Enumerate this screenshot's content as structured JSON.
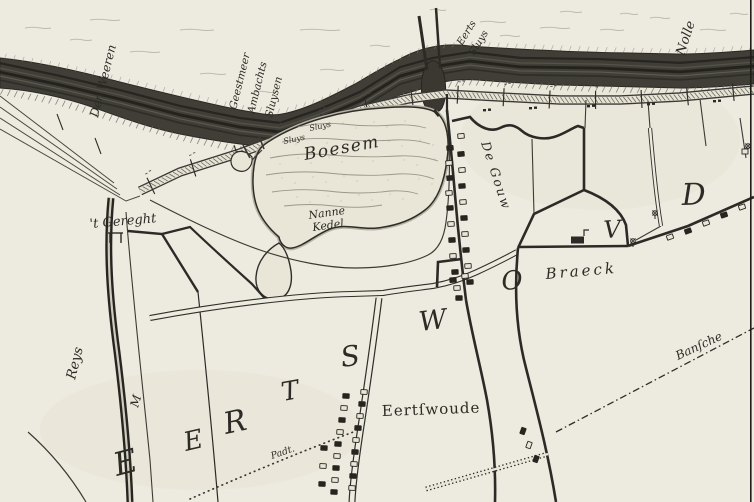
{
  "map_labels": {
    "boesem": "Boesem",
    "nanne": "Nanne",
    "kedel": "Kedel",
    "gereght": "'t Gereght",
    "de_gouw": "De Gouw",
    "braeck": "Braeck",
    "village": "Eertſwoude",
    "padt": "Padt.",
    "reys": "Reys",
    "m_letter": "M",
    "den_weeren": "Den Weeren",
    "sluice_line_1": "Geestmeer",
    "sluice_line_2": "Ambachts",
    "sluice_line_3": "Sluysen",
    "eerts": "Eerts",
    "sluys": "Sluys",
    "nolle": "Nolle",
    "bansche": "Banſche",
    "small_nw_1": "Sluys",
    "small_nw_2": "Sluys"
  },
  "district_letters": [
    "E",
    "E",
    "R",
    "T",
    "S",
    "W",
    "O",
    "V",
    "D"
  ],
  "colors": {
    "paper": "#edeadf",
    "ink": "#2c2b26",
    "dike_band": "#403e37",
    "water_core": "#cfccbd"
  }
}
